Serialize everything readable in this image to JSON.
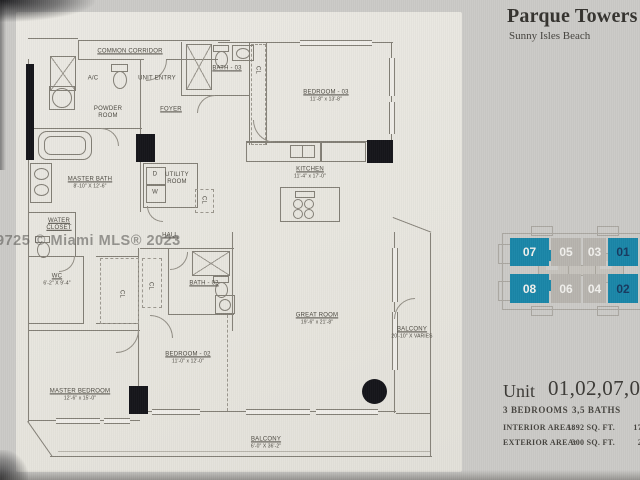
{
  "header": {
    "title": "Parque Towers",
    "subtitle": "Sunny Isles Beach"
  },
  "watermark": {
    "text": "9725 © Miami MLS® 2023"
  },
  "floorplan": {
    "labels": [
      {
        "id": "common-corridor",
        "name": "COMMON CORRIDOR",
        "x": 130,
        "y": 52,
        "u": true
      },
      {
        "id": "unit-entry",
        "name": "UNIT ENTRY",
        "x": 157,
        "y": 79
      },
      {
        "id": "ac-closet",
        "name": "A/C",
        "x": 93,
        "y": 79
      },
      {
        "id": "powder-room",
        "name": "POWDER\nROOM",
        "x": 108,
        "y": 113
      },
      {
        "id": "foyer",
        "name": "FOYER",
        "x": 171,
        "y": 110,
        "u": true
      },
      {
        "id": "bath-03",
        "name": "BATH - 03",
        "x": 227,
        "y": 69,
        "u": true
      },
      {
        "id": "bath-03-closet",
        "name": "CL",
        "x": 257,
        "y": 70,
        "rot": true
      },
      {
        "id": "bedroom-03",
        "name": "BEDROOM - 03",
        "dims": "11'-8\" x 13'-8\"",
        "x": 326,
        "y": 96
      },
      {
        "id": "kitchen",
        "name": "KITCHEN",
        "dims": "11'-4\" x 17'-0\"",
        "x": 310,
        "y": 173
      },
      {
        "id": "master-bath",
        "name": "MASTER BATH",
        "dims": "8'-10\" X 12'-6\"",
        "x": 90,
        "y": 183
      },
      {
        "id": "utility-room",
        "name": "UTILITY\nROOM",
        "x": 177,
        "y": 179
      },
      {
        "id": "dryer",
        "name": "D",
        "x": 155,
        "y": 175
      },
      {
        "id": "washer",
        "name": "W",
        "x": 155,
        "y": 193
      },
      {
        "id": "hall-closet",
        "name": "CL",
        "x": 203,
        "y": 200,
        "rot": true
      },
      {
        "id": "water-closet",
        "name": "WATER\nCLOSET",
        "x": 59,
        "y": 225,
        "u": true
      },
      {
        "id": "hall",
        "name": "HALL",
        "x": 170,
        "y": 236,
        "u": true
      },
      {
        "id": "walk-in-closet",
        "name": "WC",
        "dims": "6'-2\" X 9'-4\"",
        "x": 57,
        "y": 280
      },
      {
        "id": "closet-1",
        "name": "CL",
        "x": 121,
        "y": 294,
        "rot": true
      },
      {
        "id": "closet-2",
        "name": "CL",
        "x": 150,
        "y": 286,
        "rot": true
      },
      {
        "id": "bath-02",
        "name": "BATH - 02",
        "x": 204,
        "y": 284,
        "u": true
      },
      {
        "id": "bedroom-02",
        "name": "BEDROOM - 02",
        "dims": "11'-0\" x 12'-0\"",
        "x": 188,
        "y": 358
      },
      {
        "id": "master-bedroom",
        "name": "MASTER BEDROOM",
        "dims": "12'-6\" x 15'-0\"",
        "x": 80,
        "y": 395
      },
      {
        "id": "great-room",
        "name": "GREAT ROOM",
        "dims": "19'-6\" x 21'-8\"",
        "x": 317,
        "y": 319
      },
      {
        "id": "balcony-east",
        "name": "BALCONY",
        "dims": "20'-10\" X VARIES",
        "x": 412,
        "y": 333
      },
      {
        "id": "balcony-south",
        "name": "BALCONY",
        "dims": "6'-0\" X 36'-2\"",
        "x": 266,
        "y": 443
      }
    ]
  },
  "keyplan": {
    "colors": {
      "highlight": "#1a86a8",
      "muted": "#b7b4ae",
      "light_text": "#f1f0ed",
      "dark_text": "#17395f"
    },
    "units": [
      {
        "num": "07",
        "x": 510,
        "y": 238,
        "w": 39,
        "h": 28,
        "type": "highlight",
        "text": "light"
      },
      {
        "num": "05",
        "x": 551,
        "y": 238,
        "w": 30,
        "h": 28,
        "type": "muted",
        "text": "light"
      },
      {
        "num": "03",
        "x": 583,
        "y": 238,
        "w": 23,
        "h": 28,
        "type": "muted",
        "text": "light"
      },
      {
        "num": "01",
        "x": 608,
        "y": 238,
        "w": 30,
        "h": 28,
        "type": "highlight",
        "text": "dark"
      },
      {
        "num": "08",
        "x": 510,
        "y": 274,
        "w": 39,
        "h": 29,
        "type": "highlight",
        "text": "light"
      },
      {
        "num": "06",
        "x": 551,
        "y": 274,
        "w": 30,
        "h": 29,
        "type": "muted",
        "text": "light"
      },
      {
        "num": "04",
        "x": 583,
        "y": 274,
        "w": 23,
        "h": 29,
        "type": "muted",
        "text": "light"
      },
      {
        "num": "02",
        "x": 608,
        "y": 274,
        "w": 30,
        "h": 29,
        "type": "highlight",
        "text": "dark"
      }
    ]
  },
  "unit_info": {
    "prefix": "Unit",
    "numbers": "01,02,07,08",
    "bedrooms": "3 BEDROOMS",
    "baths": "3,5 BATHS",
    "rows": [
      {
        "label": "INTERIOR AREA:",
        "sqft": "1892 SQ. FT.",
        "partial": "17"
      },
      {
        "label": "EXTERIOR AREA:",
        "sqft": "300 SQ. FT.",
        "partial": "2"
      }
    ]
  }
}
